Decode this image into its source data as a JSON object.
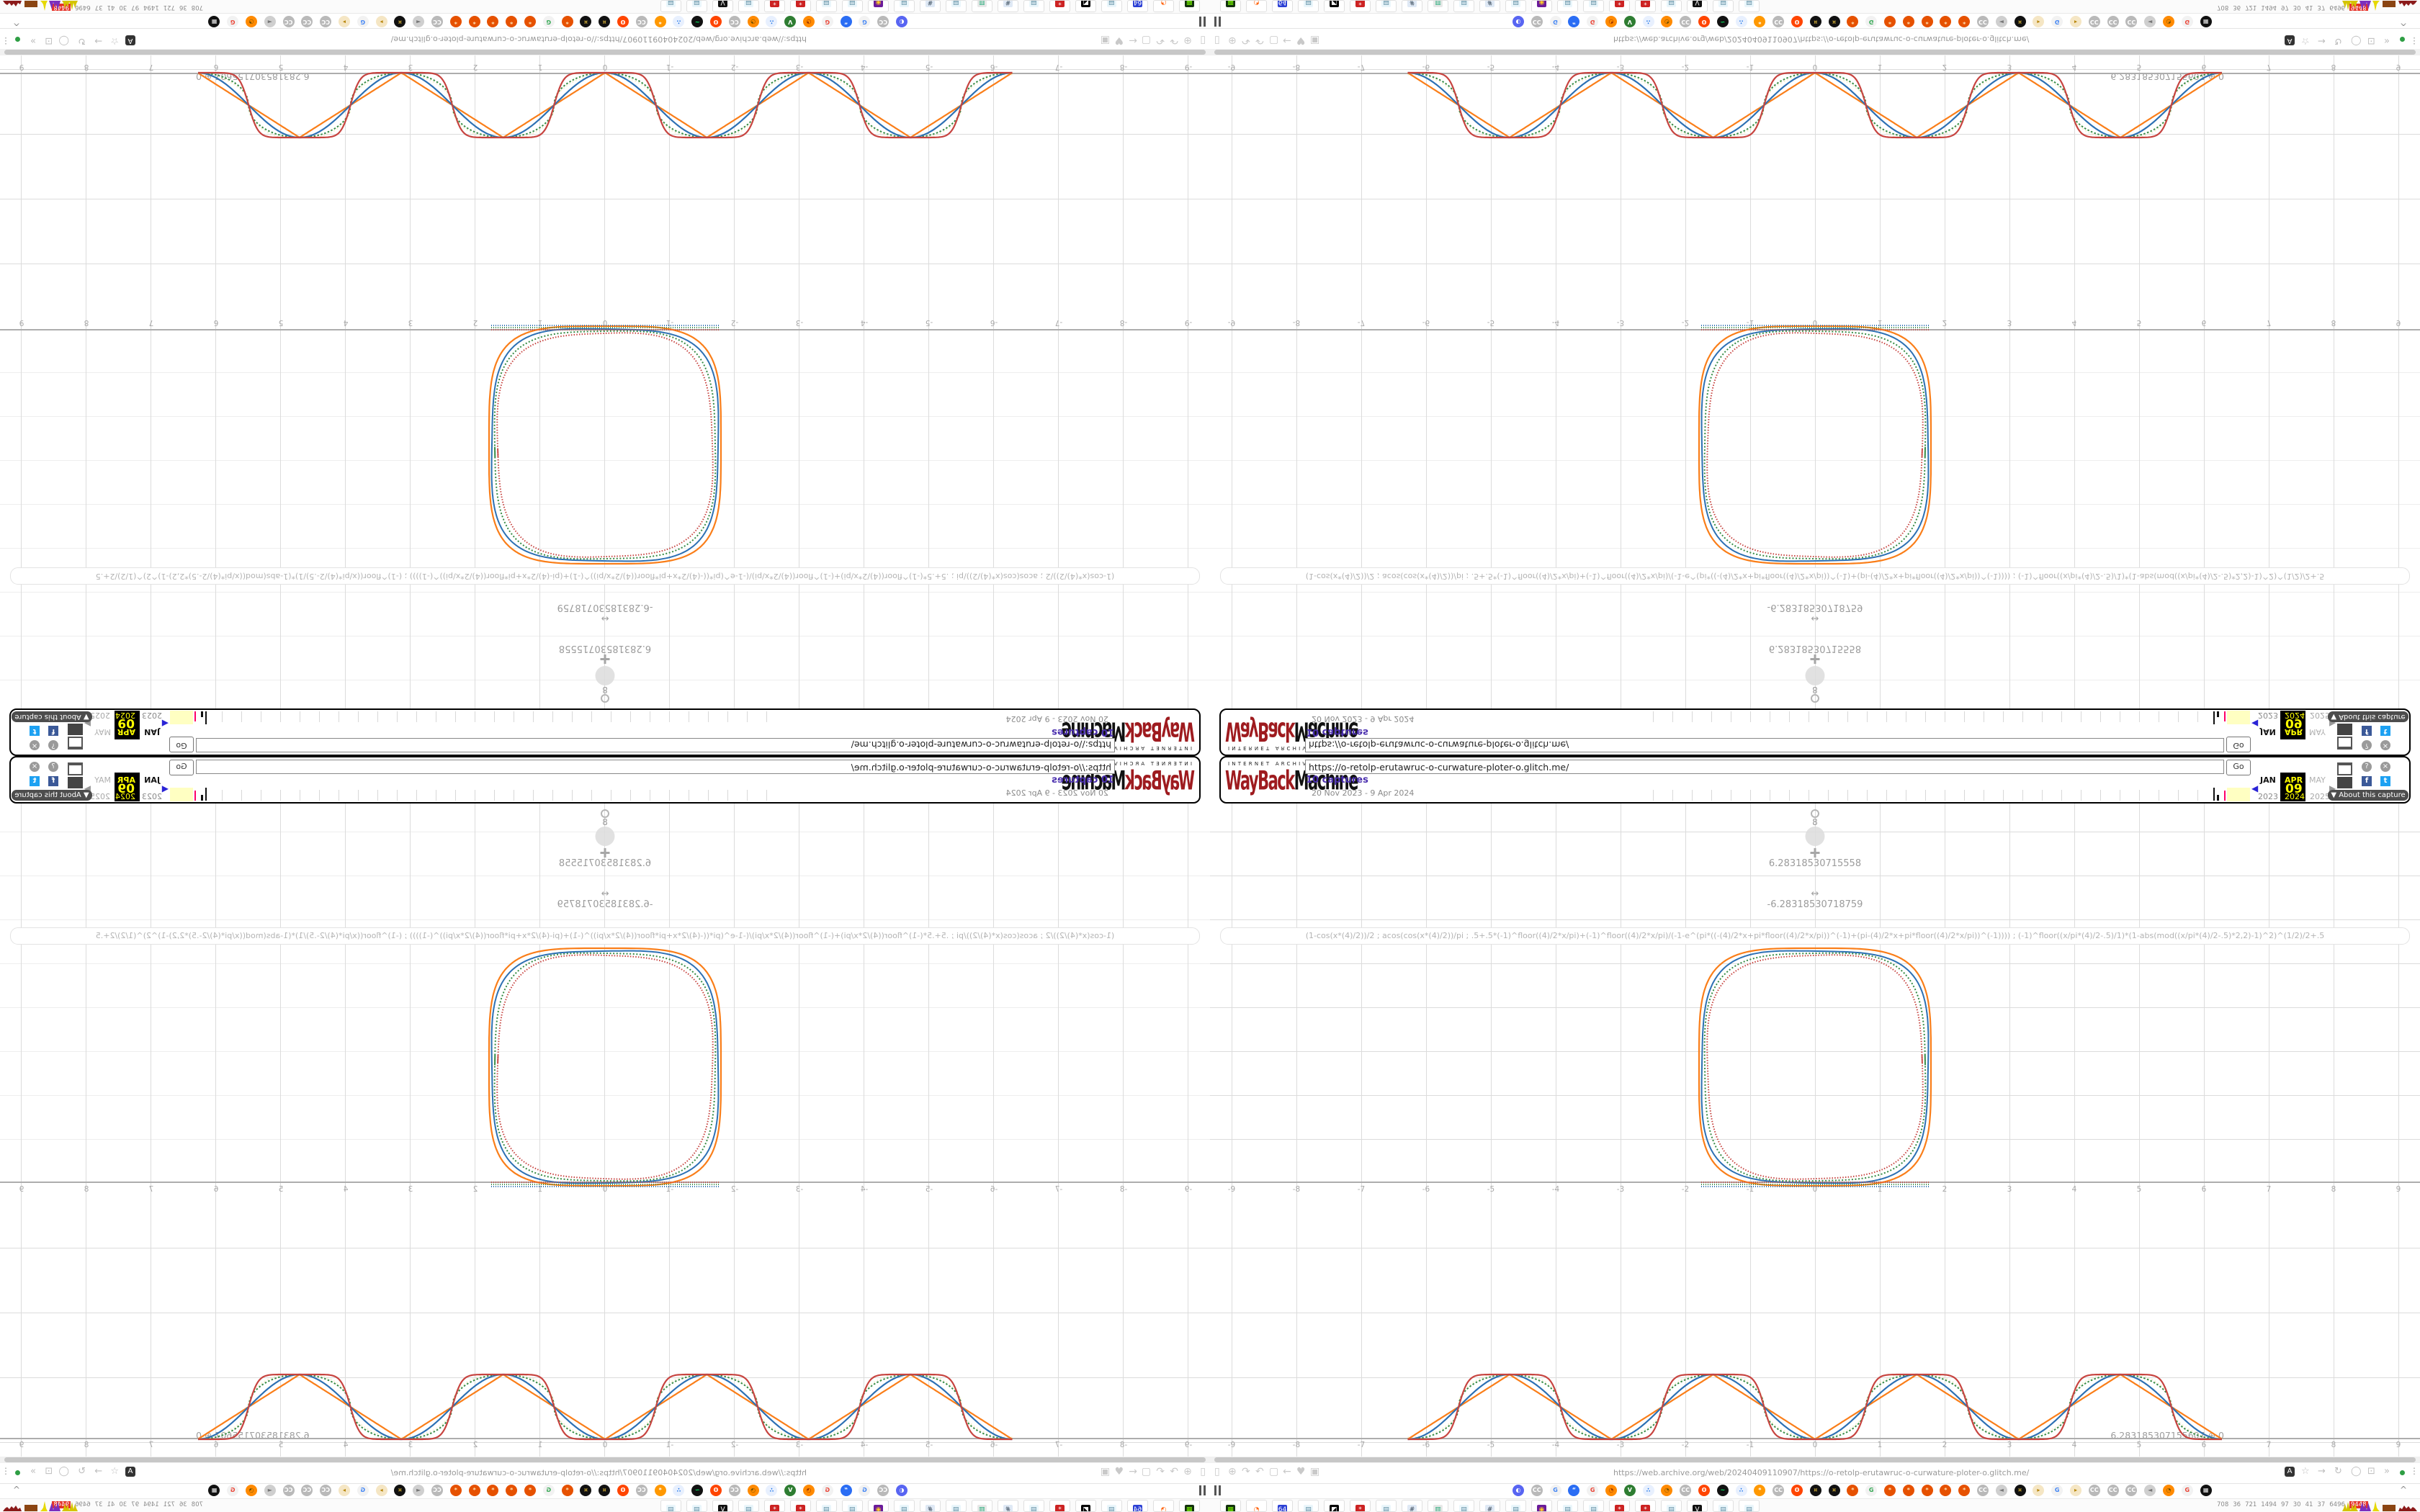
{
  "wayback_banner": {
    "logo_top": "INTERNET ARCHIVE",
    "logo_main_left": "WayBack",
    "logo_main_right": "Machine",
    "url_value": "https://o-retolp-erutawruc-o-curwature-ploter-o.glitch.me/",
    "go_label": "Go",
    "captures_link": "10 captures",
    "date_range": "20 Nov 2023 - 9 Apr 2024",
    "prev_month": "JAN",
    "current_month": "APR",
    "next_month": "MAY",
    "day": "09",
    "years": [
      "2023",
      "2024",
      "2025"
    ],
    "prev_arrow": "◀",
    "next_arrow": "▶",
    "help_icon": "?",
    "close_icon": "×",
    "share_facebook": "f",
    "share_twitter": "t",
    "about_label": "▼ About this capture",
    "colors": {
      "highlight": "#ffff00",
      "captures_link": "#4a2fae",
      "sparkline_range": "#ffffc2",
      "capture_mark": "#ff0066"
    }
  },
  "graph": {
    "slider_point_value": "8",
    "handle_value_1": "6.28318530715558",
    "handle_value_2": "-6.28318530718759",
    "endpoint_value": "6.283185307155607",
    "endpoint_handle": "⊕",
    "endpoint_y": "0",
    "formula_line": "(1-cos(x*(4)/2))/2 ; acos(cos(x*(4)/2))/pi ; .5+.5*(-1)^floor((4)/2*x/pi)+(-1)^floor((4)/2*x/pi)/(-1-e^(pi*((-(4)/2*x+pi*floor((4)/2*x/pi))^(-1)+(pi-(4)/2*x+pi*floor((4)/2*x/pi))^(-1)))) ; (-1)^floor((x/pi*(4)/2-.5)/1)*(1-abs(mod((x/pi*(4)/2-.5)*2,2)-1)^2)^(1/2)/2+.5",
    "axis_ticks": [
      -9,
      -8,
      -7,
      -6,
      -5,
      -4,
      -3,
      -2,
      -1,
      0,
      1,
      2,
      3,
      4,
      5,
      6,
      7,
      8,
      9
    ],
    "chart_data": [
      {
        "type": "line",
        "title": "periodic curvature waves",
        "xlabel": "x",
        "ylabel": "y",
        "x_range": [
          -6.2832,
          6.2832
        ],
        "y_range": [
          0,
          1
        ],
        "x_axis_ticks": [
          -9,
          -8,
          -7,
          -6,
          -5,
          -4,
          -3,
          -2,
          -1,
          0,
          1,
          2,
          3,
          4,
          5,
          6,
          7,
          8,
          9
        ],
        "grid": true,
        "period": 3.1416,
        "zeros": [
          -6.2832,
          -3.1416,
          0,
          3.1416,
          6.2832
        ],
        "peaks_x": [
          -4.7124,
          -1.5708,
          1.5708,
          4.7124
        ],
        "peak_value": 1,
        "series": [
          {
            "name": "acos(cos(x*(4)/2))/pi",
            "shape": "triangle-wave",
            "color": "#fa7e19",
            "style": "solid"
          },
          {
            "name": "(1-cos(x*(4)/2))/2",
            "shape": "raised-cosine",
            "color": "#2d70b3",
            "style": "solid"
          },
          {
            "name": "(-1)^floor((x/pi*(4)/2-.5)/1)*(1-abs(mod((x/pi*(4)/2-.5)*2,2)-1)^2)^(1/2)/2+.5",
            "shape": "semicircle-scallop",
            "color": "#388c46",
            "style": "dotted"
          },
          {
            "name": ".5+.5*(-1)^floor((4)/2*x/pi)+(-1)^floor((4)/2*x/pi)/(-1-e^(...))",
            "shape": "smoothed-square",
            "color": "#c74440",
            "style": "solid"
          },
          {
            "name": "ghost overlay",
            "shape": "semicircle-scallop",
            "color": "#e8e09a",
            "style": "dotted-faint"
          }
        ]
      },
      {
        "type": "line",
        "title": "rounded square (superellipse) resting on x-axis",
        "x_range": [
          -1.8,
          1.8
        ],
        "y_range": [
          0,
          3.7
        ],
        "center_x": 0,
        "colors": [
          "#fa7e19",
          "#2d70b3",
          "#388c46",
          "#c74440"
        ],
        "styles": [
          "solid",
          "solid",
          "dotted",
          "dotted"
        ]
      }
    ]
  },
  "chrome": {
    "url_value": "https://web.archive.org/web/20240409110907/https://o-retolp-erutawruc-o-curwature-ploter-o.glitch.me/",
    "nav_icons": [
      "▯",
      "⊕",
      "↷",
      "↶",
      "▢",
      "←",
      "♥",
      "▣"
    ],
    "translate_icon": "A",
    "action_icons": [
      "☆",
      "→",
      "↻",
      "◯",
      "⊡",
      "»"
    ],
    "menu_dots": "⋮",
    "pause_marks": "||",
    "collapse_icon": "^",
    "bookmarks": [
      {
        "t": "◐",
        "bg": "#5865f2",
        "fg": "#ffffff"
      },
      {
        "t": "CC",
        "bg": "#b9b9b9",
        "fg": "#ffffff"
      },
      {
        "t": "G",
        "bg": "#f2f2f2",
        "fg": "#4285f4"
      },
      {
        "t": "“",
        "bg": "#2a6df4",
        "fg": "#ffffff"
      },
      {
        "t": "G",
        "bg": "#f2f2f2",
        "fg": "#ea4335"
      },
      {
        "t": "◔",
        "bg": "#ff8a00",
        "fg": "#a33a00"
      },
      {
        "t": "V",
        "bg": "#2e7d32",
        "fg": "#ffffff"
      },
      {
        "t": "∴",
        "bg": "#e8f0fe",
        "fg": "#1a73e8"
      },
      {
        "t": "◔",
        "bg": "#ff8a00",
        "fg": "#7a5200"
      },
      {
        "t": "CC",
        "bg": "#b9b9b9",
        "fg": "#ffffff"
      },
      {
        "t": "ʘ",
        "bg": "#ff4500",
        "fg": "#ffffff"
      },
      {
        "t": "~",
        "bg": "#111111",
        "fg": "#00ff66"
      },
      {
        "t": "∴",
        "bg": "#e8f0fe",
        "fg": "#1a73e8"
      },
      {
        "t": "*",
        "bg": "#ff9800",
        "fg": "#ffffff"
      },
      {
        "t": "CC",
        "bg": "#b9b9b9",
        "fg": "#ffffff"
      },
      {
        "t": "ʘ",
        "bg": "#ff4500",
        "fg": "#ffffff"
      },
      {
        "t": "¤",
        "bg": "#111111",
        "fg": "#d4af37"
      },
      {
        "t": "¤",
        "bg": "#111111",
        "fg": "#d4af37"
      },
      {
        "t": "*",
        "bg": "#e65100",
        "fg": "#ffe0b2"
      },
      {
        "t": "G",
        "bg": "#f2f2f2",
        "fg": "#34a853"
      },
      {
        "t": "*",
        "bg": "#e65100",
        "fg": "#ffe0b2"
      },
      {
        "t": "*",
        "bg": "#e65100",
        "fg": "#ffe0b2"
      },
      {
        "t": "*",
        "bg": "#e65100",
        "fg": "#ffe0b2"
      },
      {
        "t": "*",
        "bg": "#e65100",
        "fg": "#ffe0b2"
      },
      {
        "t": "*",
        "bg": "#e65100",
        "fg": "#ffe0b2"
      },
      {
        "t": "CC",
        "bg": "#b9b9b9",
        "fg": "#ffffff"
      },
      {
        "t": "◄",
        "bg": "#cfcfcf",
        "fg": "#777777"
      },
      {
        "t": "¤",
        "bg": "#111111",
        "fg": "#d4af37"
      },
      {
        "t": "▸",
        "bg": "#f5e6c4",
        "fg": "#b8860b"
      },
      {
        "t": "G",
        "bg": "#f2f2f2",
        "fg": "#4285f4"
      },
      {
        "t": "▸",
        "bg": "#f5e6c4",
        "fg": "#b8860b"
      },
      {
        "t": "CC",
        "bg": "#b9b9b9",
        "fg": "#ffffff"
      },
      {
        "t": "CC",
        "bg": "#b9b9b9",
        "fg": "#ffffff"
      },
      {
        "t": "CC",
        "bg": "#b9b9b9",
        "fg": "#ffffff"
      },
      {
        "t": "◄",
        "bg": "#cfcfcf",
        "fg": "#777777"
      },
      {
        "t": "◔",
        "bg": "#ff8a00",
        "fg": "#7a5200"
      },
      {
        "t": "G",
        "bg": "#f2f2f2",
        "fg": "#ea4335"
      },
      {
        "t": "▦",
        "bg": "#111111",
        "fg": "#eeeeee"
      }
    ],
    "tabs": [
      {
        "t": "▦",
        "bg": "#14320f",
        "fg": "#7cfc00"
      },
      {
        "t": "◔",
        "bg": "#ffffff",
        "fg": "#ff6611"
      },
      {
        "t": "64",
        "bg": "#2b3fd4",
        "fg": "#ffffff"
      },
      {
        "t": "▤",
        "bg": "#eaf6fb",
        "fg": "#5a8aa0"
      },
      {
        "t": "◩",
        "bg": "#000000",
        "fg": "#ffffff"
      },
      {
        "t": "*",
        "bg": "#cc2222",
        "fg": "#ffffff"
      },
      {
        "t": "▤",
        "bg": "#eaf6fb",
        "fg": "#5a8aa0"
      },
      {
        "t": "#",
        "bg": "#dfe9f5",
        "fg": "#334455"
      },
      {
        "t": "▥",
        "bg": "#e8e8e8",
        "fg": "#22aa77"
      },
      {
        "t": "▤",
        "bg": "#eaf6fb",
        "fg": "#5a8aa0"
      },
      {
        "t": "#",
        "bg": "#dfe9f5",
        "fg": "#334455"
      },
      {
        "t": "▤",
        "bg": "#eaf6fb",
        "fg": "#5a8aa0"
      },
      {
        "t": "◉",
        "bg": "#6a1b9a",
        "fg": "#ffca28"
      },
      {
        "t": "▤",
        "bg": "#eaf6fb",
        "fg": "#5a8aa0"
      },
      {
        "t": "▤",
        "bg": "#eaf6fb",
        "fg": "#5a8aa0"
      },
      {
        "t": "*",
        "bg": "#cc2222",
        "fg": "#ffffff"
      },
      {
        "t": "*",
        "bg": "#cc2222",
        "fg": "#ffffff"
      },
      {
        "t": "▤",
        "bg": "#eaf6fb",
        "fg": "#5a8aa0"
      },
      {
        "t": "V",
        "bg": "#111111",
        "fg": "#ffffff"
      },
      {
        "t": "▤",
        "bg": "#eaf6fb",
        "fg": "#5a8aa0"
      },
      {
        "t": "▤",
        "bg": "#eaf6fb",
        "fg": "#5a8aa0"
      }
    ],
    "tab_counters": [
      "708",
      "36",
      "721",
      "1494",
      "97",
      "30",
      "41",
      "37",
      "6496"
    ],
    "counter_highlight": "9448"
  }
}
